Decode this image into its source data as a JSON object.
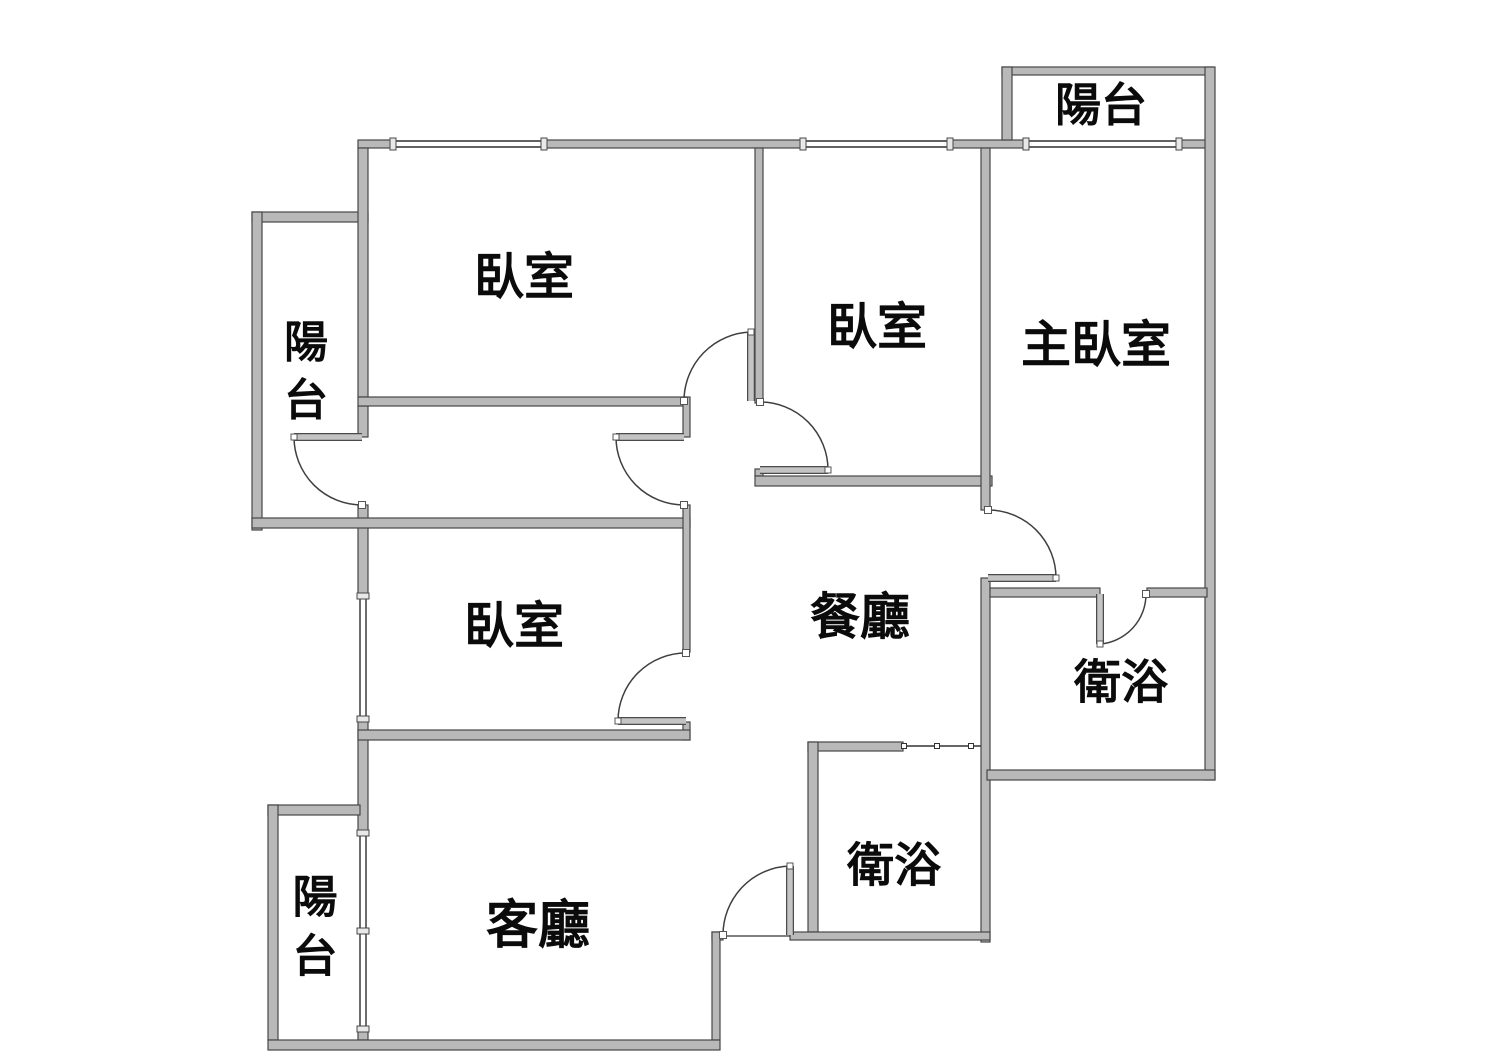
{
  "title": "公寓平面圖",
  "canvas": {
    "w": 1510,
    "h": 1062,
    "bg": "#ffffff"
  },
  "style": {
    "wall_fill": "#b9b9b9",
    "wall_stroke": "#474747",
    "door_arc_color": "#3f3f3f",
    "door_leaf_fill": "#c4c4c4",
    "door_leaf_edge": "#4a4a4a",
    "window_color": "#2e2e2e",
    "window_cap_fill": "#e8e8e8",
    "jamb_fill": "#ffffff",
    "label_color": "#0b0b0b"
  },
  "rooms": [
    {
      "id": "bedroom-top-left",
      "label": "臥室",
      "x": 524,
      "y": 277,
      "vertical": false,
      "size": 50
    },
    {
      "id": "bedroom-top-middle",
      "label": "臥室",
      "x": 877,
      "y": 327,
      "vertical": false,
      "size": 50
    },
    {
      "id": "master-bedroom",
      "label": "主臥室",
      "x": 1096,
      "y": 345,
      "vertical": false,
      "size": 50
    },
    {
      "id": "balcony-top-right",
      "label": "陽台",
      "x": 1101,
      "y": 105,
      "vertical": false,
      "size": 46
    },
    {
      "id": "balcony-left",
      "label": "陽台",
      "x": 306,
      "y": 371,
      "vertical": true,
      "size": 44
    },
    {
      "id": "bedroom-middle-left",
      "label": "臥室",
      "x": 514,
      "y": 626,
      "vertical": false,
      "size": 50
    },
    {
      "id": "dining-room",
      "label": "餐廳",
      "x": 860,
      "y": 617,
      "vertical": false,
      "size": 50
    },
    {
      "id": "bathroom-right",
      "label": "衛浴",
      "x": 1121,
      "y": 682,
      "vertical": false,
      "size": 47
    },
    {
      "id": "bathroom-center",
      "label": "衛浴",
      "x": 894,
      "y": 865,
      "vertical": false,
      "size": 47
    },
    {
      "id": "living-room",
      "label": "客廳",
      "x": 538,
      "y": 926,
      "vertical": false,
      "size": 52
    },
    {
      "id": "balcony-bottom-left",
      "label": "陽台",
      "x": 315,
      "y": 926,
      "vertical": true,
      "size": 45
    }
  ],
  "walls": [
    {
      "name": "top-wall-seg-1",
      "x": 358,
      "y": 140,
      "w": 37,
      "h": 8
    },
    {
      "name": "top-wall-seg-2",
      "x": 542,
      "y": 140,
      "w": 263,
      "h": 8
    },
    {
      "name": "top-wall-seg-3",
      "x": 948,
      "y": 140,
      "w": 80,
      "h": 8
    },
    {
      "name": "top-wall-seg-4",
      "x": 1177,
      "y": 140,
      "w": 36,
      "h": 8
    },
    {
      "name": "balcony-tr-top-wall",
      "x": 1002,
      "y": 67,
      "w": 211,
      "h": 8
    },
    {
      "name": "balcony-tr-left-wall",
      "x": 1002,
      "y": 67,
      "w": 10,
      "h": 73
    },
    {
      "name": "east-exterior-wall",
      "x": 1205,
      "y": 67,
      "w": 10,
      "h": 713
    },
    {
      "name": "balcony-left-top-wall",
      "x": 252,
      "y": 212,
      "w": 116,
      "h": 10
    },
    {
      "name": "balcony-left-outer-wall",
      "x": 252,
      "y": 212,
      "w": 10,
      "h": 318
    },
    {
      "name": "west-wall-seg-1",
      "x": 358,
      "y": 148,
      "w": 10,
      "h": 249
    },
    {
      "name": "west-wall-seg-2",
      "x": 358,
      "y": 406,
      "w": 10,
      "h": 31
    },
    {
      "name": "west-wall-seg-3",
      "x": 358,
      "y": 505,
      "w": 10,
      "h": 93
    },
    {
      "name": "west-wall-seg-4",
      "x": 358,
      "y": 717,
      "w": 10,
      "h": 118
    },
    {
      "name": "west-wall-seg-5",
      "x": 358,
      "y": 1027,
      "w": 10,
      "h": 13
    },
    {
      "name": "bedroom-tl-south-wall",
      "x": 358,
      "y": 397,
      "w": 329,
      "h": 9
    },
    {
      "name": "divider-tl-tm-wall",
      "x": 755,
      "y": 148,
      "w": 8,
      "h": 255
    },
    {
      "name": "divider-tl-tm-jamb",
      "x": 755,
      "y": 469,
      "w": 8,
      "h": 7
    },
    {
      "name": "bedroom-tm-south-wall",
      "x": 755,
      "y": 476,
      "w": 237,
      "h": 10
    },
    {
      "name": "corridor-south-wall",
      "x": 252,
      "y": 518,
      "w": 438,
      "h": 10
    },
    {
      "name": "hall-divider-seg-1",
      "x": 683,
      "y": 397,
      "w": 7,
      "h": 40
    },
    {
      "name": "hall-divider-seg-2",
      "x": 683,
      "y": 505,
      "w": 7,
      "h": 147
    },
    {
      "name": "hall-divider-seg-3",
      "x": 683,
      "y": 722,
      "w": 7,
      "h": 18
    },
    {
      "name": "bedroom-ml-south-wall",
      "x": 358,
      "y": 730,
      "w": 332,
      "h": 10
    },
    {
      "name": "central-divider-seg-1",
      "x": 981,
      "y": 148,
      "w": 9,
      "h": 362
    },
    {
      "name": "central-divider-seg-2",
      "x": 981,
      "y": 578,
      "w": 9,
      "h": 364
    },
    {
      "name": "bath-right-top-seg-1",
      "x": 990,
      "y": 588,
      "w": 110,
      "h": 9
    },
    {
      "name": "bath-right-top-seg-2",
      "x": 1147,
      "y": 588,
      "w": 60,
      "h": 9
    },
    {
      "name": "bath-right-south-wall",
      "x": 987,
      "y": 770,
      "w": 228,
      "h": 10
    },
    {
      "name": "bath-center-top-wall",
      "x": 808,
      "y": 742,
      "w": 95,
      "h": 9
    },
    {
      "name": "bath-center-left-wall",
      "x": 808,
      "y": 742,
      "w": 10,
      "h": 190
    },
    {
      "name": "entry-wall-seg-1",
      "x": 790,
      "y": 932,
      "w": 200,
      "h": 8
    },
    {
      "name": "entry-wall-seg-2",
      "x": 712,
      "y": 932,
      "w": 11,
      "h": 8
    },
    {
      "name": "living-se-jog-wall",
      "x": 712,
      "y": 932,
      "w": 8,
      "h": 108
    },
    {
      "name": "balcony-bl-top-wall",
      "x": 268,
      "y": 805,
      "w": 92,
      "h": 10
    },
    {
      "name": "balcony-bl-outer-wall",
      "x": 268,
      "y": 805,
      "w": 10,
      "h": 235
    },
    {
      "name": "south-exterior-wall",
      "x": 268,
      "y": 1040,
      "w": 452,
      "h": 10
    }
  ],
  "windows": [
    {
      "name": "window-bedroom-top-left",
      "o": "h",
      "x": 395,
      "y": 144,
      "len": 147
    },
    {
      "name": "window-bedroom-top-middle",
      "o": "h",
      "x": 805,
      "y": 144,
      "len": 143
    },
    {
      "name": "window-master-bedroom",
      "o": "h",
      "x": 1028,
      "y": 144,
      "len": 149
    },
    {
      "name": "window-bedroom-middle-left",
      "o": "v",
      "x": 363,
      "y": 598,
      "len": 119
    },
    {
      "name": "window-living-room",
      "o": "v",
      "x": 363,
      "y": 835,
      "len": 192,
      "mid_cap": true
    }
  ],
  "doors": [
    {
      "name": "door-bedroom-top-left",
      "hinge": [
        751,
        401
      ],
      "open": [
        751,
        332
      ],
      "closed": [
        684,
        401
      ],
      "sweep": 0
    },
    {
      "name": "door-balcony-left",
      "hinge": [
        362,
        437
      ],
      "open": [
        294,
        437
      ],
      "closed": [
        362,
        505
      ],
      "sweep": 0
    },
    {
      "name": "door-corridor",
      "hinge": [
        684,
        437
      ],
      "open": [
        616,
        437
      ],
      "closed": [
        684,
        505
      ],
      "sweep": 0
    },
    {
      "name": "door-bedroom-top-middle",
      "hinge": [
        760,
        470
      ],
      "open": [
        828,
        470
      ],
      "closed": [
        760,
        402
      ],
      "sweep": 0
    },
    {
      "name": "door-bedroom-middle-left",
      "hinge": [
        686,
        721
      ],
      "open": [
        618,
        721
      ],
      "closed": [
        686,
        653
      ],
      "sweep": 1
    },
    {
      "name": "door-master-bedroom",
      "hinge": [
        988,
        578
      ],
      "open": [
        1056,
        578
      ],
      "closed": [
        988,
        510
      ],
      "sweep": 0
    },
    {
      "name": "door-bathroom-right",
      "hinge": [
        1100,
        594
      ],
      "open": [
        1100,
        644
      ],
      "closed": [
        1146,
        594
      ],
      "sweep": 0
    },
    {
      "name": "door-entry",
      "hinge": [
        790,
        935
      ],
      "open": [
        790,
        866
      ],
      "closed": [
        723,
        935
      ],
      "sweep": 0
    }
  ],
  "sliding_doors": [
    {
      "name": "sliding-door-bathroom-center",
      "x1": 903,
      "y1": 746,
      "x2": 981,
      "y2": 746,
      "ticks": [
        904,
        937,
        971
      ]
    }
  ],
  "thresholds": [
    {
      "name": "entry-threshold",
      "x1": 723,
      "y1": 936,
      "x2": 790,
      "y2": 936
    }
  ]
}
